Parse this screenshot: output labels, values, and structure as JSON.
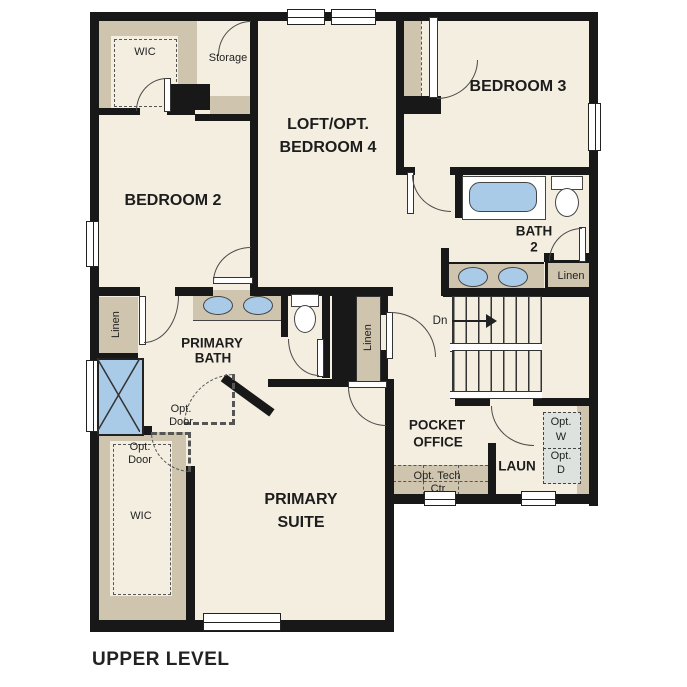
{
  "title": "UPPER LEVEL",
  "colors": {
    "floor": "#f4eee1",
    "closet_tan": "#cfc4ae",
    "wall_black": "#181818",
    "fixture_blue": "#a9cbe8",
    "optional_appliance_gray": "#dde2df"
  },
  "rooms": {
    "bedroom2": "BEDROOM 2",
    "loft_line1": "LOFT/OPT.",
    "loft_line2": "BEDROOM 4",
    "bedroom3": "BEDROOM 3",
    "bath2_line1": "BATH",
    "bath2_line2": "2",
    "primary_bath_line1": "PRIMARY",
    "primary_bath_line2": "BATH",
    "primary_suite_line1": "PRIMARY",
    "primary_suite_line2": "SUITE",
    "pocket_office_line1": "POCKET",
    "pocket_office_line2": "OFFICE",
    "laundry": "LAUN"
  },
  "closets": {
    "wic_upper": "WIC",
    "wic_lower": "WIC",
    "storage": "Storage",
    "linen_bath2": "Linen",
    "linen_primary": "Linen",
    "linen_hall": "Linen"
  },
  "annotations": {
    "stairs_down": "Dn",
    "opt_door_upper_line1": "Opt.",
    "opt_door_upper_line2": "Door",
    "opt_door_lower_line1": "Opt.",
    "opt_door_lower_line2": "Door",
    "opt_tech_line1": "Opt. Tech",
    "opt_tech_line2": "Ctr",
    "opt_washer_line1": "Opt.",
    "opt_washer_line2": "W",
    "opt_dryer_line1": "Opt.",
    "opt_dryer_line2": "D"
  }
}
